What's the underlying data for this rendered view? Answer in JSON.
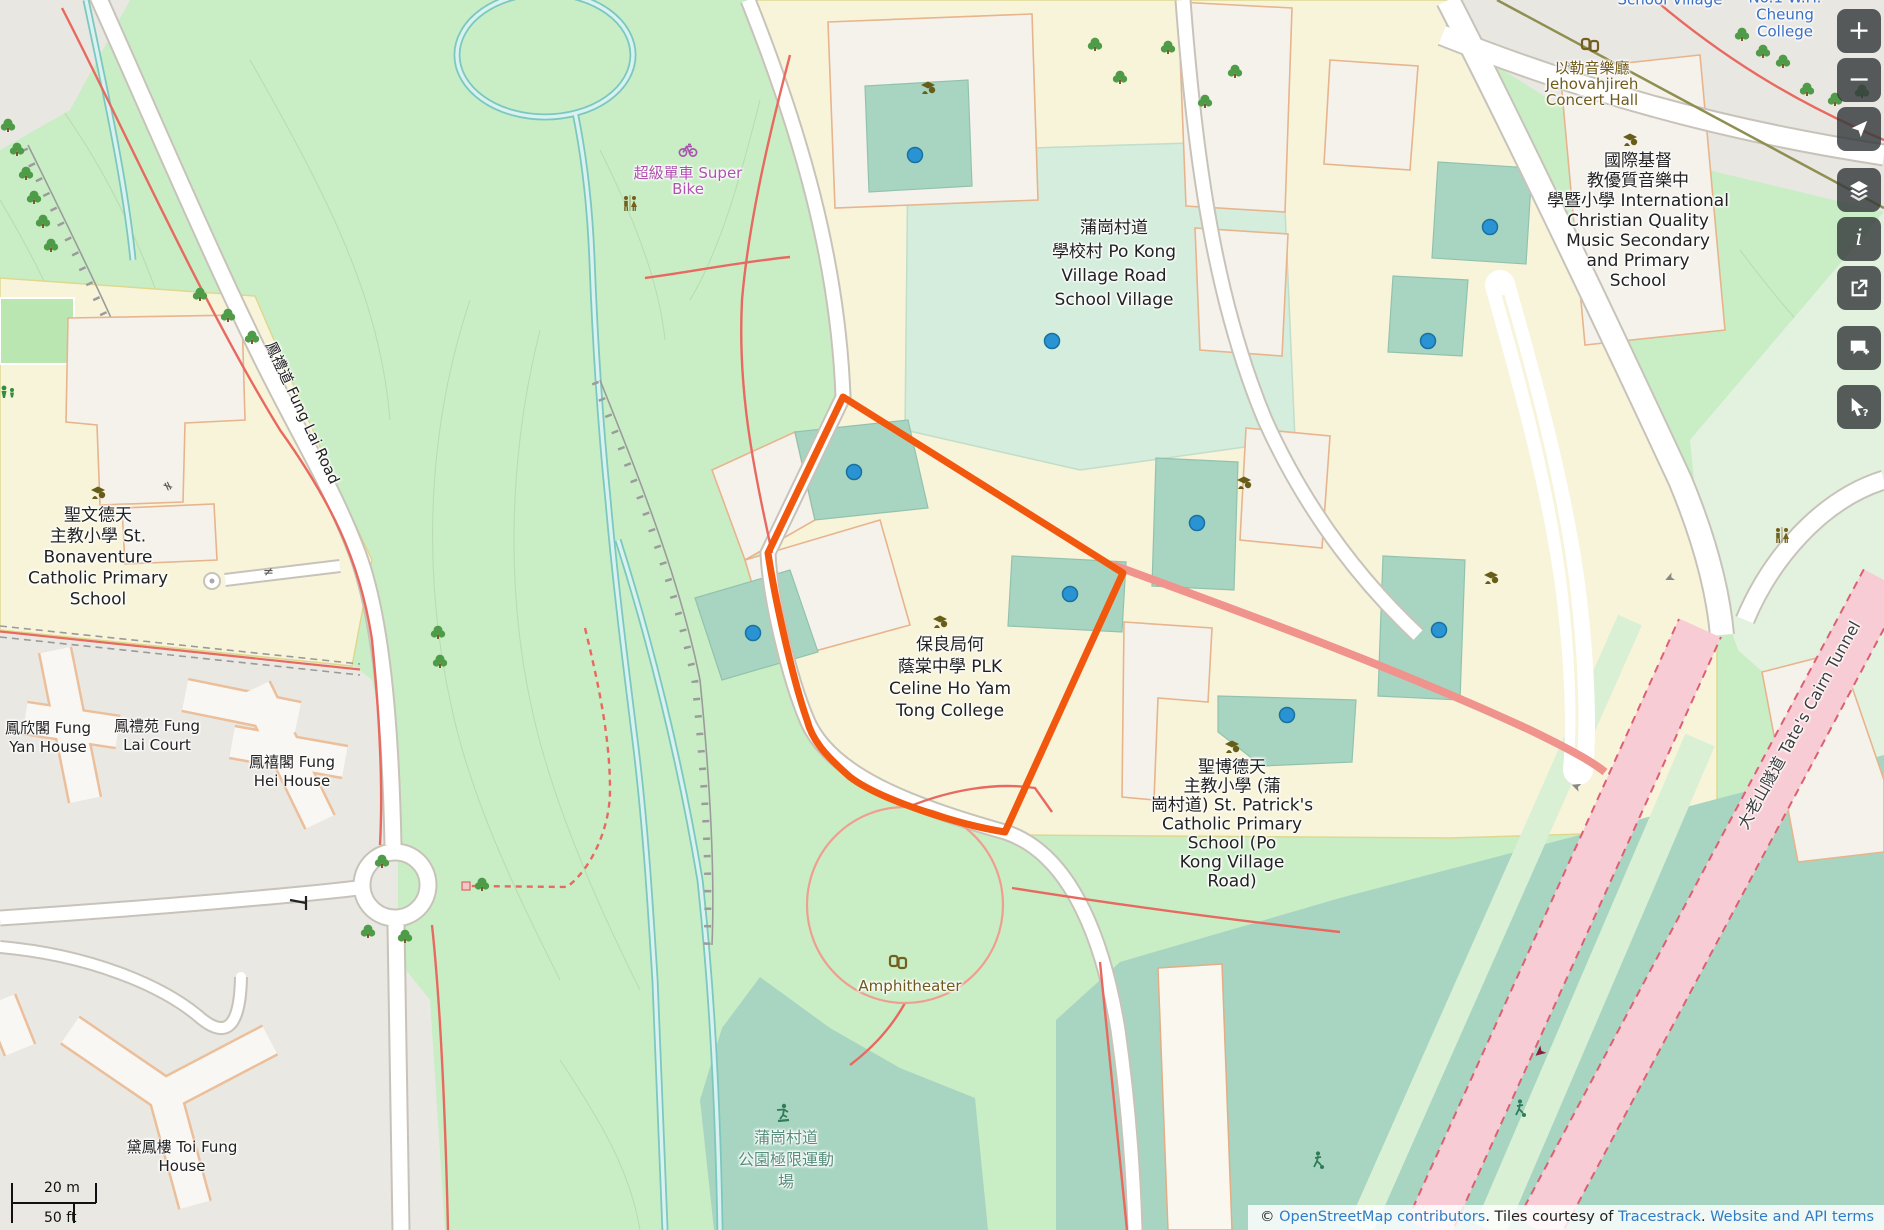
{
  "labels": {
    "school_village_top": "School Village",
    "cheung_college": "No.1 W.H. Cheung\nCollege",
    "concert_hall": "以勒音樂廳\nJehovahjireh\nConcert Hall",
    "intl_school": "國際基督\n教優質音樂中\n學暨小學 International\nChristian Quality\nMusic Secondary\nand Primary\nSchool",
    "po_kong_village": "蒲崗村道\n學校村 Po Kong\nVillage Road\nSchool Village",
    "plk_college": "保良局何\n蔭棠中學 PLK\nCeline Ho Yam\nTong College",
    "st_patricks": "聖博德天\n主教小學 (蒲\n崗村道) St. Patrick's\nCatholic Primary\nSchool (Po\nKong Village\nRoad)",
    "st_bonaventure": "聖文德天\n主教小學 St.\nBonaventure\nCatholic Primary\nSchool",
    "super_bike": "超級單車 Super\nBike",
    "fung_yan_house": "鳳欣閣 Fung\nYan House",
    "fung_lai_court": "鳳禮苑 Fung\nLai Court",
    "fung_hei_house": "鳳禧閣 Fung\nHei House",
    "toi_fung_house": "黛鳳樓 Toi Fung\nHouse",
    "amphitheater": "Amphitheater",
    "skatepark": "蒲崗村道\n公園極限運動\n場",
    "fung_lai_road": "鳳禮道 Fung Lai Road",
    "tates_cairn_tunnel": "大老山隧道 Tate's Cairn Tunnel"
  },
  "controls": {
    "zoom_in": "+",
    "zoom_out": "−"
  },
  "scalebar": {
    "metric": "20 m",
    "imperial": "50 ft"
  },
  "attribution": {
    "copyright": "© ",
    "osm_link": "OpenStreetMap contributors",
    "middle": ". Tiles courtesy of ",
    "tracestrack_link": "Tracestrack",
    "period": ". ",
    "terms_link": "Website and API terms"
  },
  "colors": {
    "park": "#c9eec6",
    "pitch": "#a8d5c1",
    "field": "#d4eddc",
    "campus": "#f8f4da",
    "highlight_orange": "#f2570e",
    "marker_blue": "#2a93d3",
    "tunnel_pink": "#f8ccd4"
  }
}
